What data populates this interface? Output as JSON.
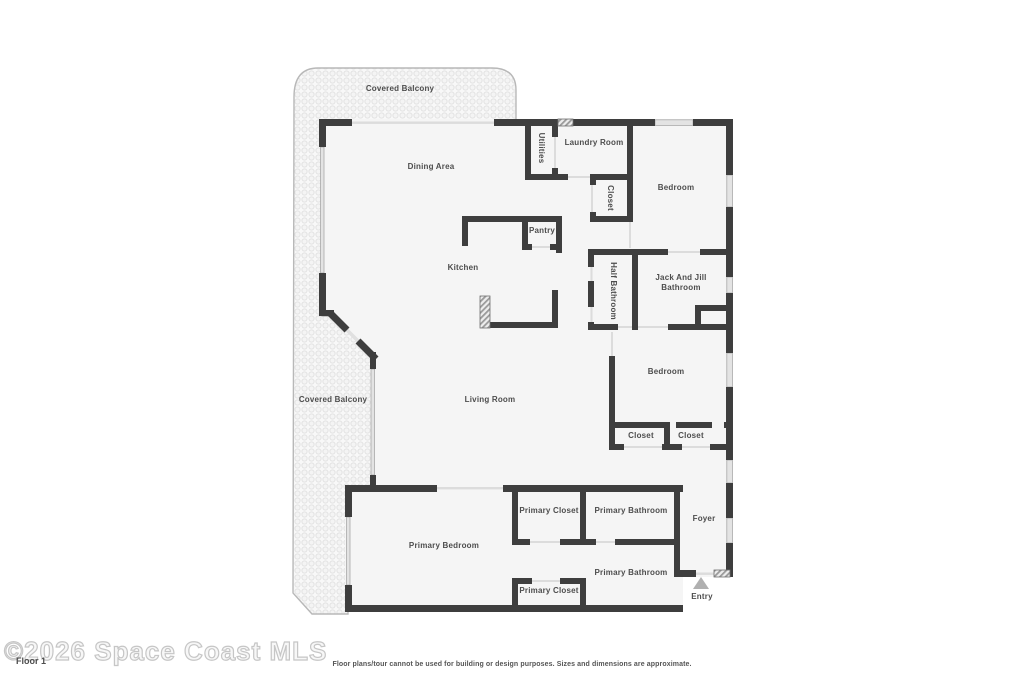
{
  "footer": {
    "watermark": "©2026 Space Coast MLS",
    "floor_label": "Floor 1",
    "disclaimer": "Floor plans/tour cannot be used for building or design purposes. Sizes and dimensions are approximate."
  },
  "rooms": [
    {
      "name": "Covered Balcony"
    },
    {
      "name": "Dining Area"
    },
    {
      "name": "Utilities"
    },
    {
      "name": "Laundry Room"
    },
    {
      "name": "Closet"
    },
    {
      "name": "Bedroom"
    },
    {
      "name": "Pantry"
    },
    {
      "name": "Kitchen"
    },
    {
      "name": "Half Bathroom"
    },
    {
      "name": "Jack And Jill Bathroom"
    },
    {
      "name": "Bedroom"
    },
    {
      "name": "Covered Balcony"
    },
    {
      "name": "Living Room"
    },
    {
      "name": "Closet"
    },
    {
      "name": "Closet"
    },
    {
      "name": "Primary Closet"
    },
    {
      "name": "Primary Bathroom"
    },
    {
      "name": "Foyer"
    },
    {
      "name": "Primary Bedroom"
    },
    {
      "name": "Primary Bathroom"
    },
    {
      "name": "Primary Closet"
    },
    {
      "name": "Entry"
    }
  ],
  "colors": {
    "wall": "#3e3e3e",
    "room_fill": "#f5f5f5",
    "balcony_fill": "#f8f8f8",
    "window_fill": "#e3e3e3",
    "door_opening": "#dcdcdc",
    "label_text": "#4d4d4d",
    "watermark_outline": "#c6c6c6"
  }
}
